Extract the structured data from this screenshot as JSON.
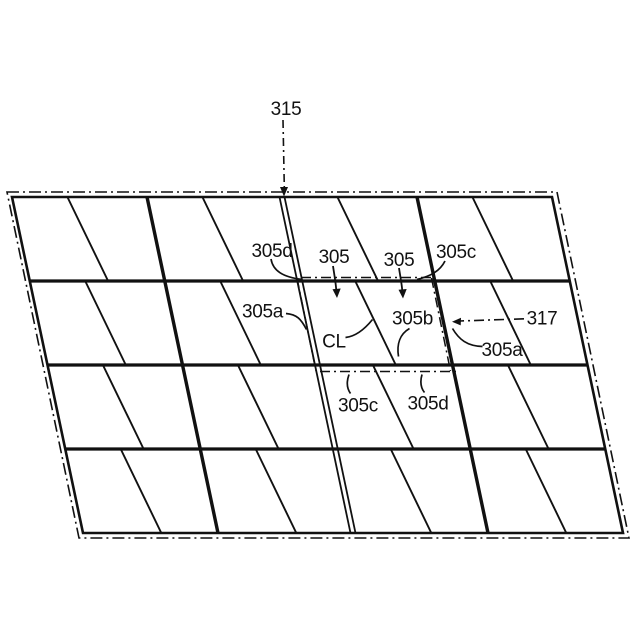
{
  "figure": {
    "type": "patent-line-drawing",
    "background": "#ffffff",
    "line_color": "#111111",
    "labels": {
      "display_panel": "315",
      "pixel_region": "317",
      "subpixel_left": "305",
      "subpixel_right": "305",
      "center_line": "CL",
      "subpixel_b": "305b",
      "edge_top_left": "305d",
      "edge_top_right": "305c",
      "edge_left": "305a",
      "edge_right": "305a",
      "edge_bottom_left": "305c",
      "edge_bottom_right": "305d"
    }
  }
}
